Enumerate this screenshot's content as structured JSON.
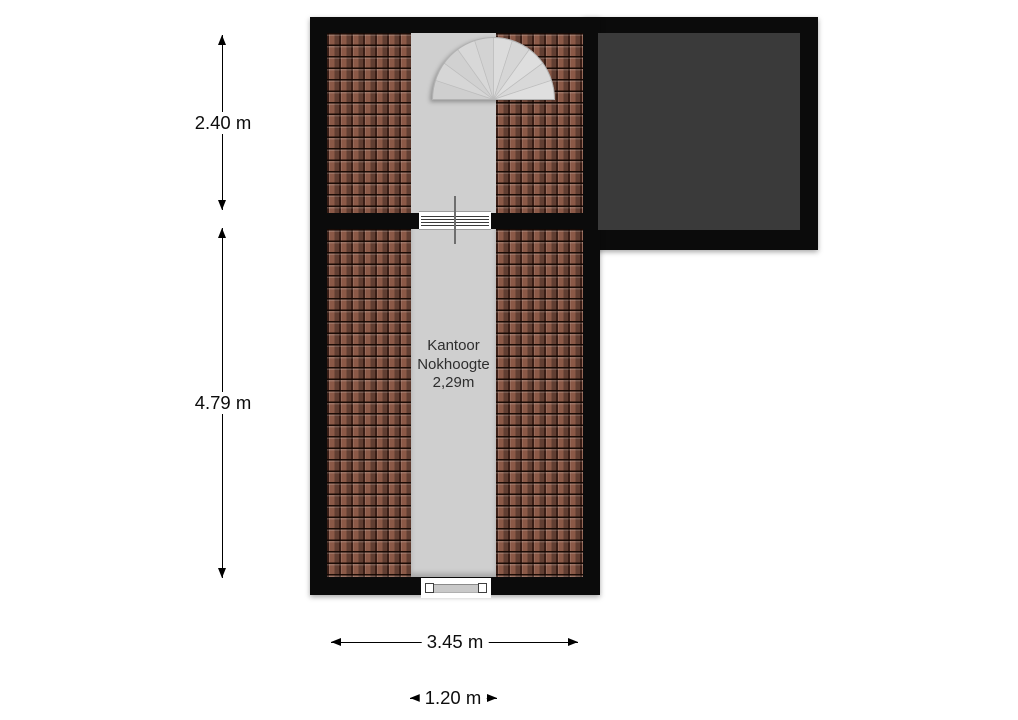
{
  "floorplan": {
    "room": {
      "label_lines": [
        "Kantoor",
        "Nokhoogte",
        "2,29m"
      ]
    },
    "dimensions": {
      "upper_section_depth": "2.40 m",
      "lower_section_depth": "4.79 m",
      "overall_width": "3.45 m",
      "corridor_width": "1.20 m"
    },
    "icons": {
      "staircase": "spiral-staircase-icon",
      "window": "window-symbol-icon",
      "door": "door-threshold-icon",
      "arrows": [
        "arrow-up-icon",
        "arrow-down-icon",
        "arrow-left-icon",
        "arrow-right-icon"
      ]
    },
    "colors": {
      "wall": "#0b0b0b",
      "roof_tiles": "#8b5947",
      "floor": "#cfcfcf",
      "flat_roof": "#3a3a3a",
      "staircase": "#dadada"
    }
  }
}
